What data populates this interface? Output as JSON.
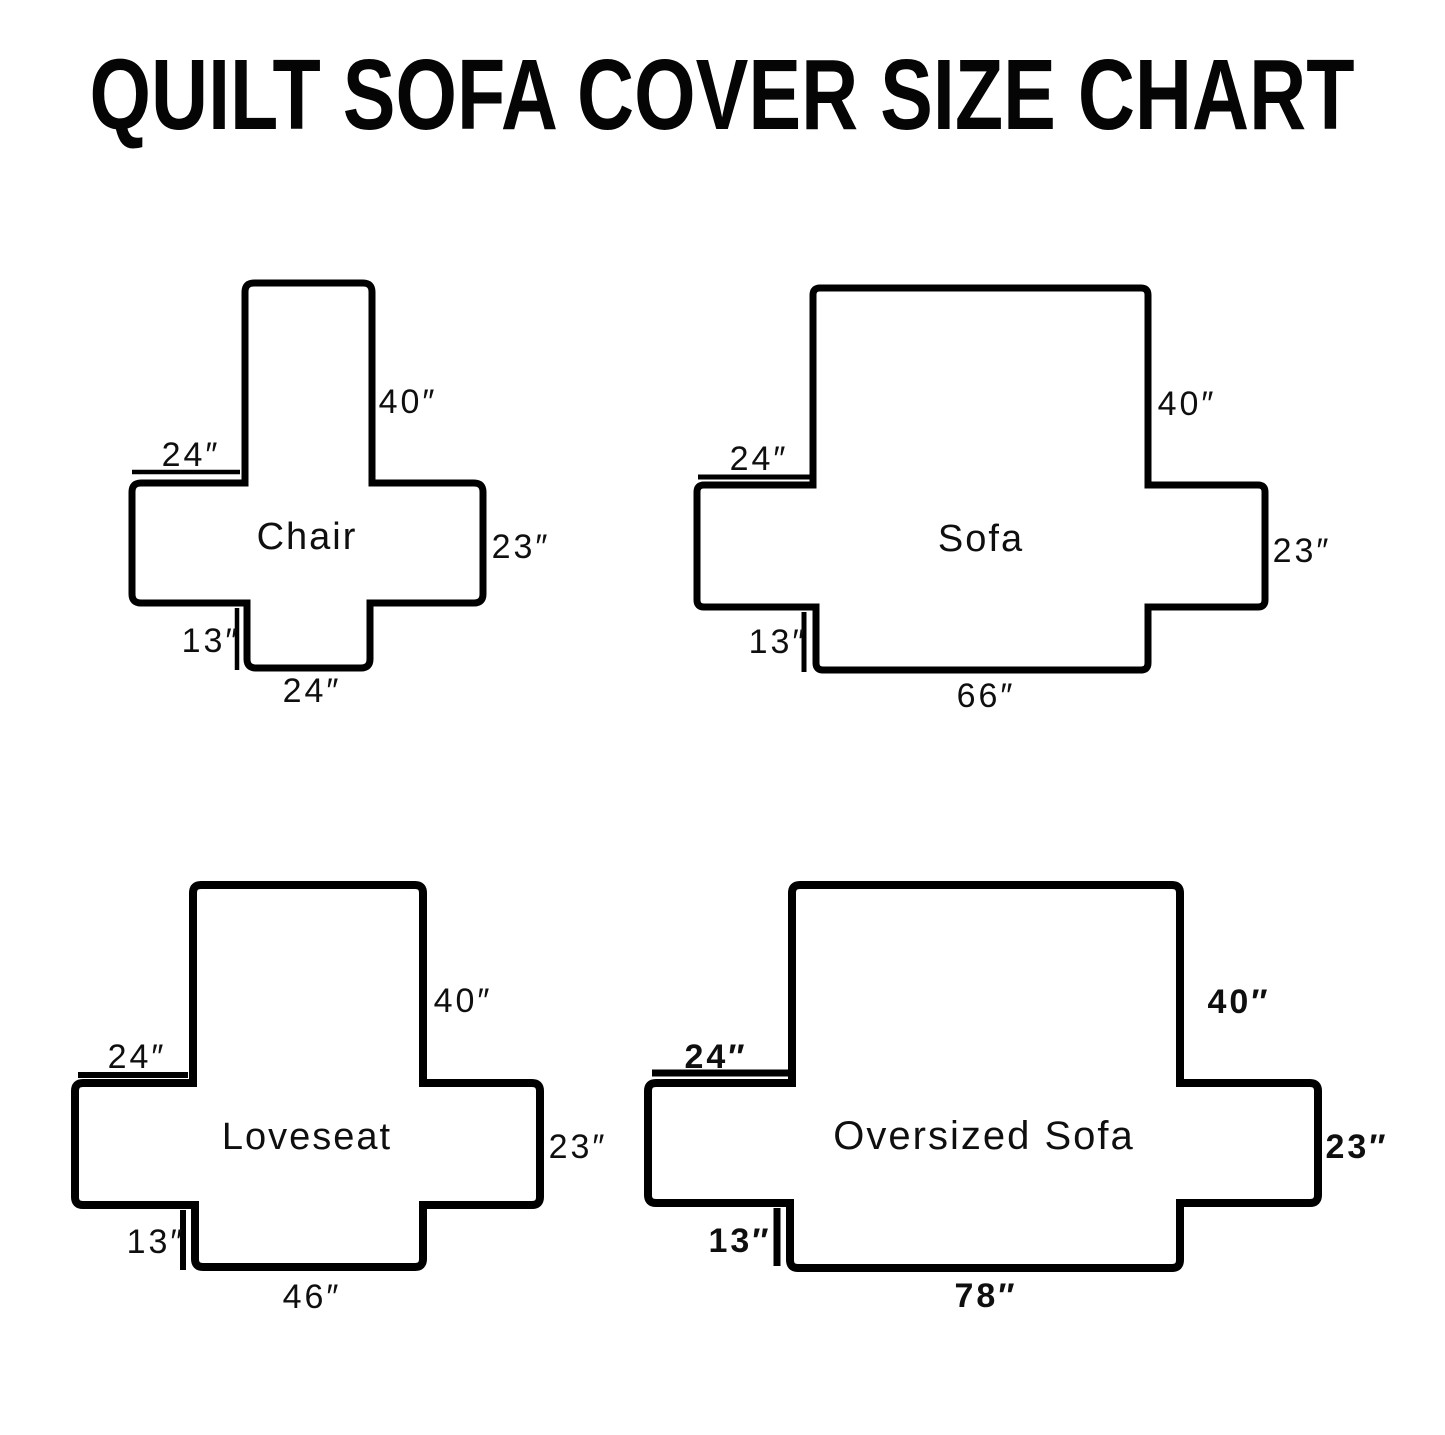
{
  "title": "QUILT SOFA COVER SIZE CHART",
  "colors": {
    "ink": "#000000",
    "background": "#ffffff"
  },
  "figures": {
    "chair": {
      "label": "Chair",
      "back_height": "40″",
      "arm_width": "24″",
      "side_height": "23″",
      "front_skirt_height": "13″",
      "seat_width": "24″"
    },
    "sofa": {
      "label": "Sofa",
      "back_height": "40″",
      "arm_width": "24″",
      "side_height": "23″",
      "front_skirt_height": "13″",
      "seat_width": "66″"
    },
    "loveseat": {
      "label": "Loveseat",
      "back_height": "40″",
      "arm_width": "24″",
      "side_height": "23″",
      "front_skirt_height": "13″",
      "seat_width": "46″"
    },
    "oversized_sofa": {
      "label": "Oversized Sofa",
      "back_height": "40″",
      "arm_width": "24″",
      "side_height": "23″",
      "front_skirt_height": "13″",
      "seat_width": "78″"
    }
  }
}
